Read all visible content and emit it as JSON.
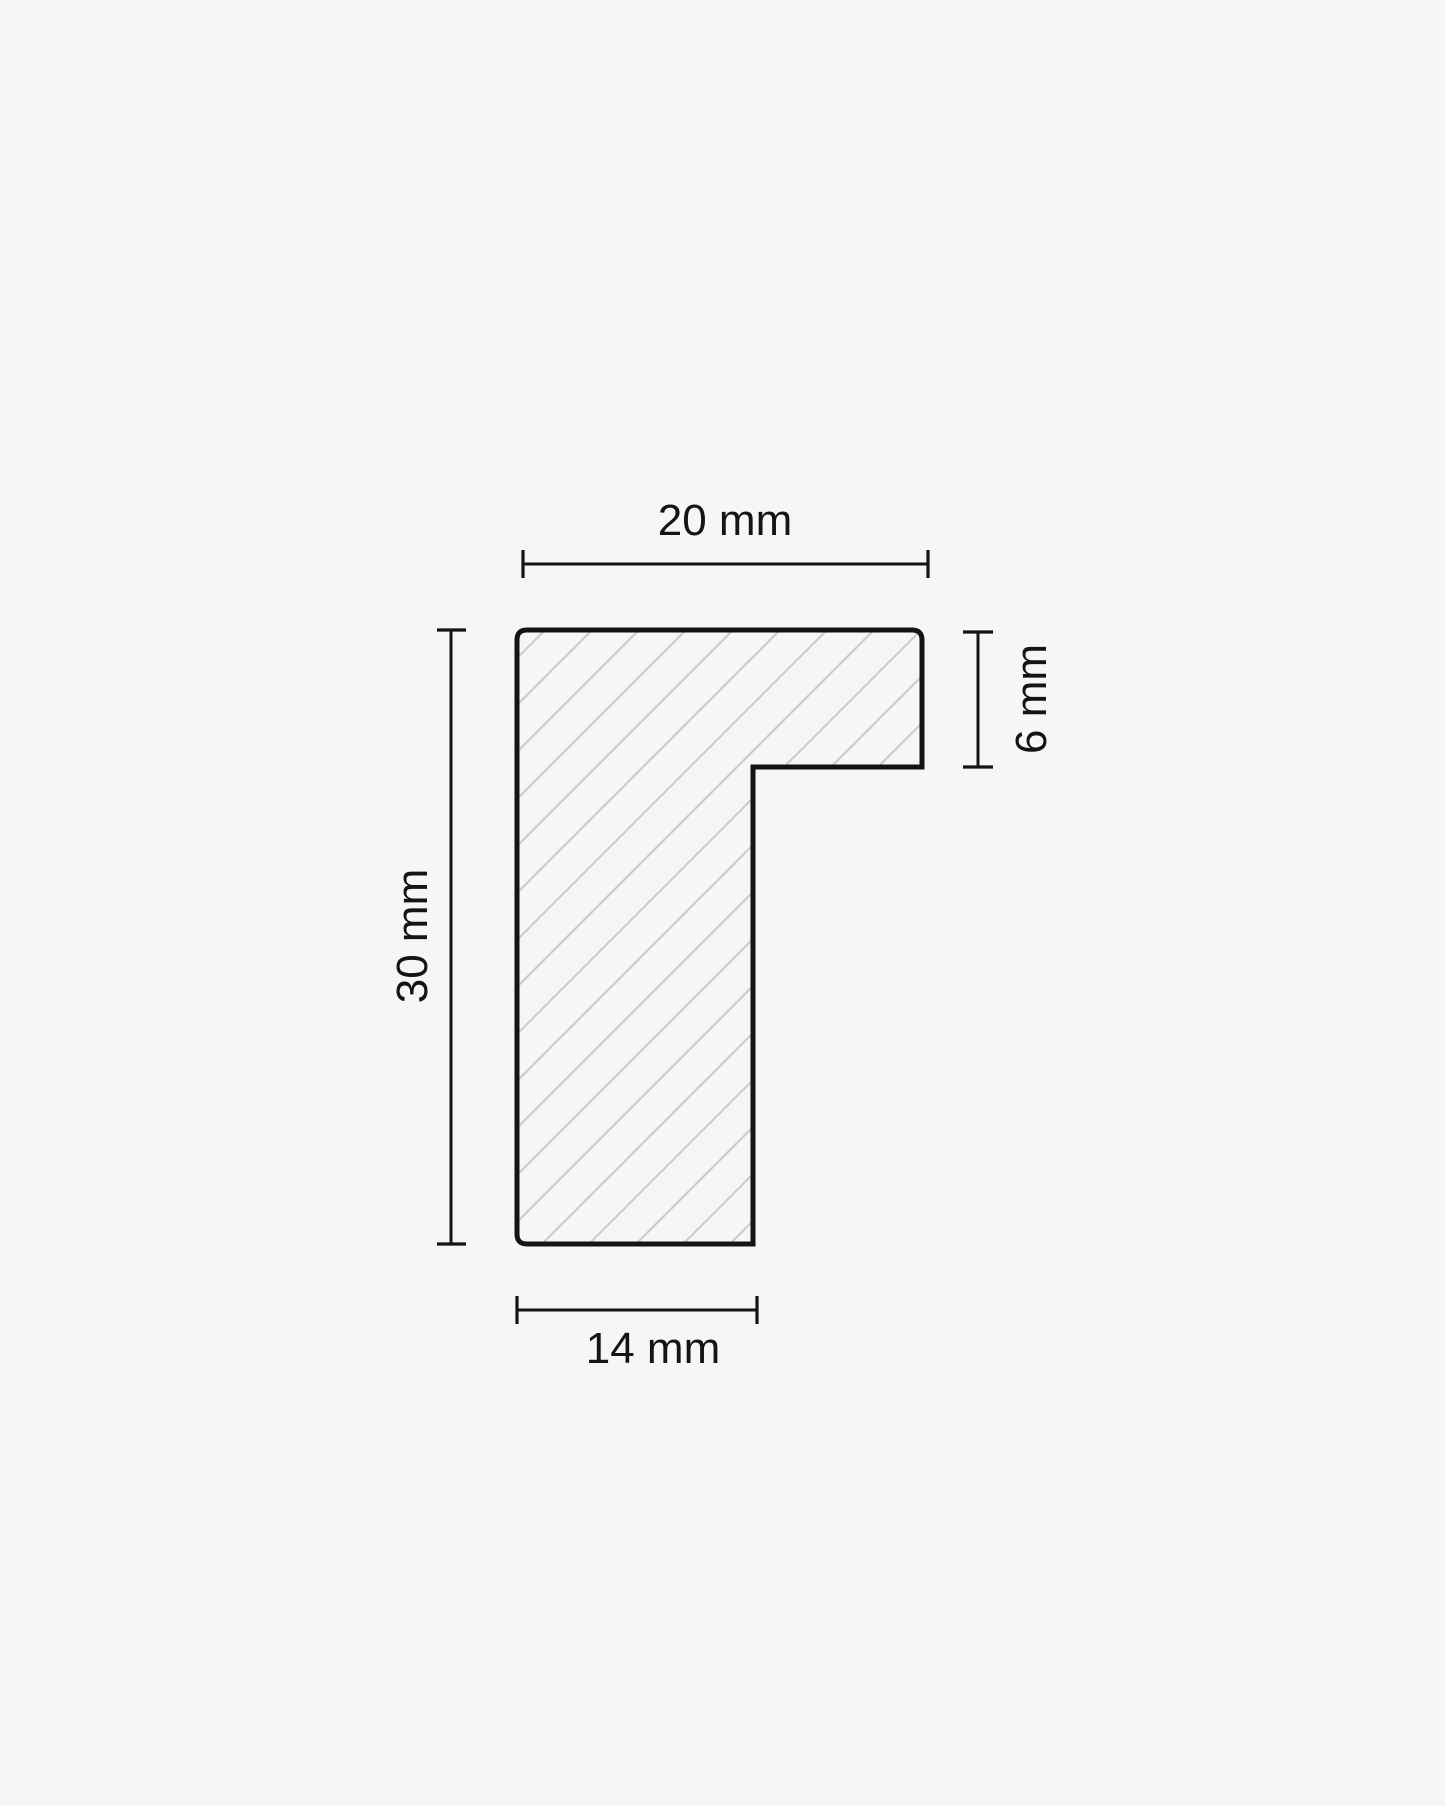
{
  "diagram": {
    "type": "frame-moulding-cross-section",
    "dimensions": {
      "width_top": {
        "label": "20 mm",
        "value": 20,
        "unit": "mm",
        "position": "top"
      },
      "height_left": {
        "label": "30 mm",
        "value": 30,
        "unit": "mm",
        "position": "left"
      },
      "lip_right": {
        "label": "6 mm",
        "value": 6,
        "unit": "mm",
        "position": "right"
      },
      "base_bottom": {
        "label": "14 mm",
        "value": 14,
        "unit": "mm",
        "position": "bottom"
      }
    },
    "colors": {
      "background": "#f6f6f7",
      "line": "#141414",
      "hatch": "#c9c9cc"
    }
  }
}
